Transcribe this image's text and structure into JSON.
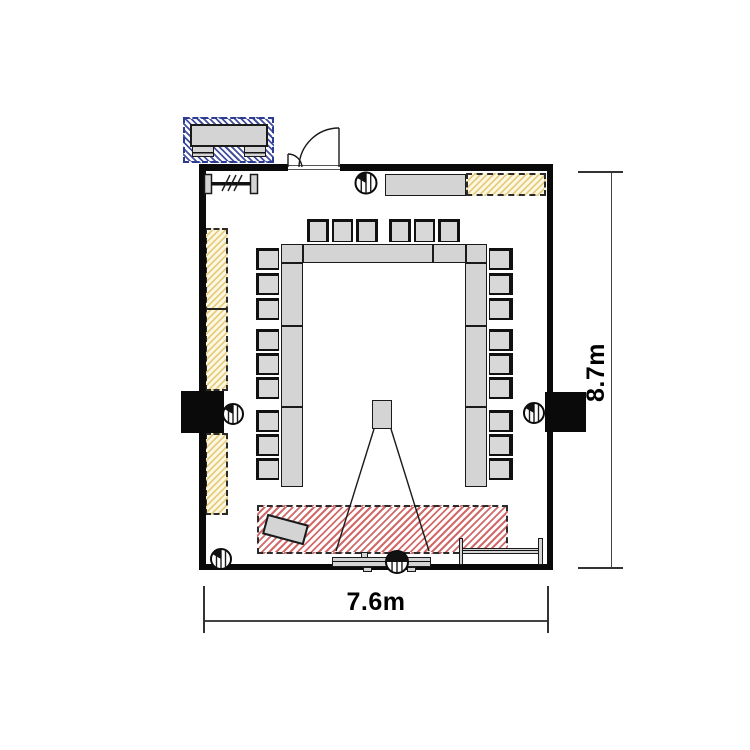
{
  "dimensions": {
    "width": {
      "label": "7.6m",
      "value_m": 7.6
    },
    "height": {
      "label": "8.7m",
      "value_m": 8.7
    }
  },
  "colors": {
    "wall": "#0a0a0a",
    "furniture_fill": "#d4d4d4",
    "furniture_border": "#1a1a1a",
    "yellow_hatch_line": "#e7cd7f",
    "yellow_hatch_bg": "#fdf8e4",
    "red_hatch_line": "#d26a6a",
    "blue_hatch_line": "#44509e",
    "blue_hatch_border": "#2c3b94",
    "dimension_line": "#444444",
    "text": "#000000"
  },
  "inventory": {
    "u_table_segments": 10,
    "chairs_total": 24,
    "chairs_top_row": 6,
    "chairs_left_row": 9,
    "chairs_right_row": 9,
    "projector": 1,
    "projection_screen": 1,
    "lectern": 1,
    "sideboard": 1,
    "av_cabinet_outside_room": 1,
    "wall_units": 2,
    "column_symbols": 5,
    "double_door": 1,
    "radiator_symbol": 1,
    "wall_rail": 1,
    "yellow_hatch_zones": 3,
    "red_screen_zone": 1
  }
}
